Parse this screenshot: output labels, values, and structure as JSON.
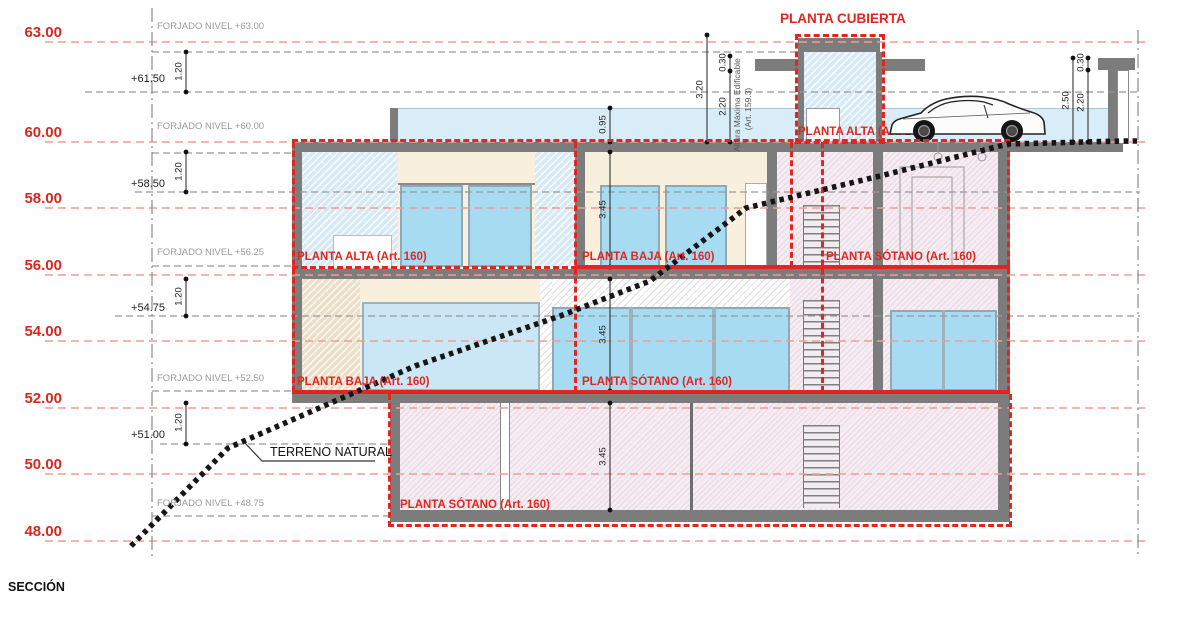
{
  "title": {
    "section": "SECCIÓN"
  },
  "levels": [
    "63.00",
    "60.00",
    "58.00",
    "56.00",
    "54.00",
    "52.00",
    "50.00",
    "48.00"
  ],
  "sub_levels": [
    "+61.50",
    "+58.50",
    "+54.75",
    "+51.00"
  ],
  "forjado_labels": [
    "FORJADO NIVEL +63.00",
    "FORJADO NIVEL +60.00",
    "FORJADO NIVEL +56.25",
    "FORJADO NIVEL +52.50",
    "FORJADO NIVEL +48.75"
  ],
  "planta_labels": {
    "cubierta": "PLANTA CUBIERTA",
    "roof_alta": "PLANTA ALTA (Art. 160)",
    "r1_alta": "PLANTA ALTA (Art. 160)",
    "r1_baja": "PLANTA BAJA (Art. 160)",
    "r1_sotano": "PLANTA SÓTANO (Art. 160)",
    "r2_baja": "PLANTA BAJA (Art. 160)",
    "r2_sotano": "PLANTA SÓTANO (Art. 160)",
    "basement_sotano": "PLANTA SÓTANO (Art. 160)"
  },
  "annotations": {
    "terrain": "TERRENO NATURAL",
    "altura_maxima": "Altura Máxima Edificable",
    "altura_maxima_art": "(Art. 159.3)"
  },
  "dimensions": {
    "floor_gap": "1.20",
    "parapet": "0.95",
    "storey": "3.45",
    "tower_height": "3.20",
    "slab": "0.30",
    "clear": "2.20",
    "right_height": "2.50"
  },
  "colors": {
    "box_red": "#e2251e",
    "level_red": "#d8281e",
    "level_dash_red": "#f49b93",
    "slab_gray": "#7c7c7c",
    "glass_blue": "#a7dbf2",
    "envelope_band_blue": "#d9edf8",
    "basement_pink": "#f6edf3"
  }
}
